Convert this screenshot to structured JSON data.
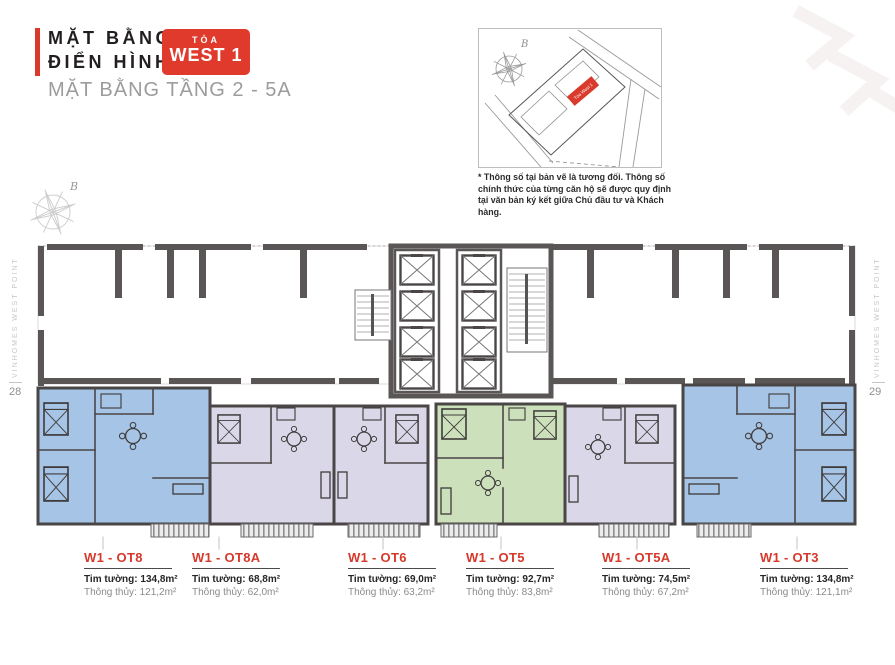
{
  "header": {
    "title": "MẶT BẰNG\nĐIỂN HÌNH",
    "badge_top": "TÒA",
    "badge_bottom": "WEST 1",
    "subtitle": "MẶT BẰNG TẦNG 2 - 5A"
  },
  "site_map": {
    "compass_label": "B",
    "building_label": "Tòa West 1"
  },
  "disclaimer": "* Thông số tại bản vẽ là tương đối. Thông số chính thức của từng căn hộ sẽ được quy định tại văn bản ký kết giữa Chủ đầu tư và Khách hàng.",
  "side_rails": {
    "left_text": "VINHOMES WEST POINT",
    "left_page": "28",
    "right_text": "VINHOMES WEST POINT",
    "right_page": "29"
  },
  "plan": {
    "compass_label": "B"
  },
  "units": [
    {
      "name": "W1 - OT8",
      "area_wall": "Tim tường: 134,8m²",
      "area_clear": "Thông thủy: 121,2m²",
      "color": "#a6c4e5"
    },
    {
      "name": "W1 - OT8A",
      "area_wall": "Tim tường: 68,8m²",
      "area_clear": "Thông thủy: 62,0m²",
      "color": "#dad7e9"
    },
    {
      "name": "W1 - OT6",
      "area_wall": "Tim tường: 69,0m²",
      "area_clear": "Thông thủy: 63,2m²",
      "color": "#dad7e9"
    },
    {
      "name": "W1 - OT5",
      "area_wall": "Tim tường: 92,7m²",
      "area_clear": "Thông thủy: 83,8m²",
      "color": "#cde0bc"
    },
    {
      "name": "W1 - OT5A",
      "area_wall": "Tim tường: 74,5m²",
      "area_clear": "Thông thủy: 67,2m²",
      "color": "#dad7e9"
    },
    {
      "name": "W1 - OT3",
      "area_wall": "Tim tường: 134,8m²",
      "area_clear": "Thông thủy: 121,1m²",
      "color": "#a6c4e5"
    }
  ],
  "colors": {
    "accent_red": "#d93a2c",
    "wall_dark": "#5b5656",
    "unit_blue": "#a6c4e5",
    "unit_lavender": "#dad7e9",
    "unit_green": "#cde0bc"
  }
}
